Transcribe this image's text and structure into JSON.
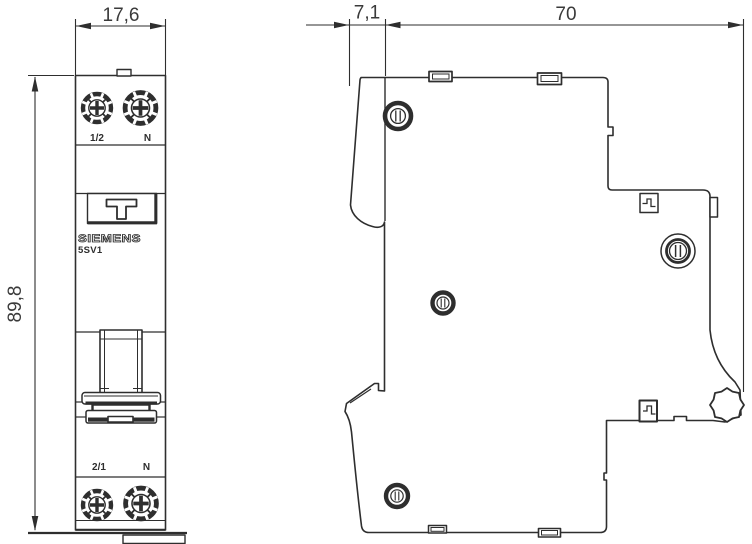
{
  "drawing": {
    "title": "Siemens 5SV1 miniature circuit breaker dimension drawing",
    "brand": "SIEMENS",
    "model": "5SV1",
    "colors": {
      "ink": "#2e2e2e",
      "dim": "#3a3a3a",
      "bg": "#ffffff"
    },
    "dimensions": {
      "width": "17,6",
      "height": "89,8",
      "front_depth": "7,1",
      "body_depth": "70"
    },
    "front_view": {
      "top_terminals": {
        "left": "1/2",
        "right": "N"
      },
      "bottom_terminals": {
        "left": "2/1",
        "right": "N"
      }
    }
  }
}
